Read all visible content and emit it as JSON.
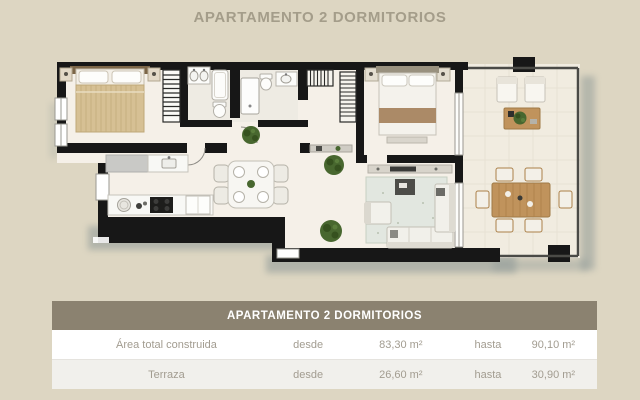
{
  "page": {
    "title": "APARTAMENTO 2 DORMITORIOS"
  },
  "palette": {
    "background": "#ddd6c2",
    "title_text": "#a49d8a",
    "table_header_bg": "#8b8270",
    "table_header_text": "#ffffff",
    "table_row_text": "#a29c90",
    "row_alt_bg": "#f1f0ec",
    "wall": "#171717",
    "floor": "#f5f0e8",
    "terrace_floor": "#f1ece0",
    "wood": "#c0935c",
    "plant": "#48672f",
    "shadow": "#8d9896"
  },
  "table": {
    "header": "APARTAMENTO 2 DORMITORIOS",
    "rows": [
      {
        "label": "Área total construida",
        "from_word": "desde",
        "from_value": "83,30 m²",
        "to_word": "hasta",
        "to_value": "90,10 m²"
      },
      {
        "label": "Terraza",
        "from_word": "desde",
        "from_value": "26,60 m²",
        "to_word": "hasta",
        "to_value": "30,90 m²"
      }
    ]
  }
}
